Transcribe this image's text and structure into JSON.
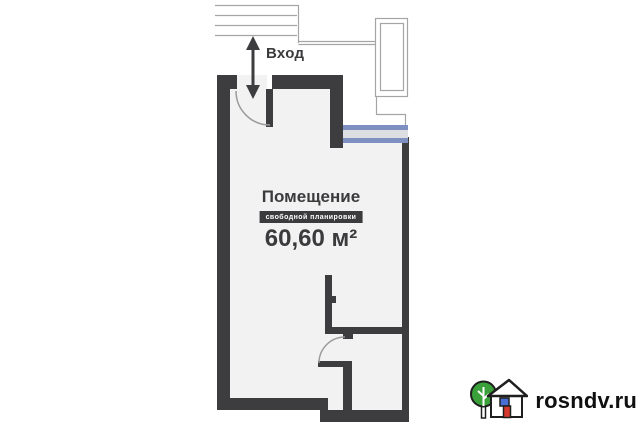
{
  "plan": {
    "entrance": {
      "label": "Вход"
    },
    "room": {
      "title": "Помещение",
      "badge": "свободной планировки",
      "area": "60,60 м²"
    }
  },
  "watermark": {
    "site": "rosndv.ru",
    "logo": "house-and-tree-icon"
  },
  "colors": {
    "wall": "#3d3d3f",
    "room_fill": "#f2f2f3",
    "outline_gray": "#a5a5a7",
    "door_arc_gray": "#9b9b9d",
    "window_blue": "#7e90c2",
    "window_fill": "#dcdee2",
    "badge_bg": "#3b3b3d",
    "badge_text": "#ffffff",
    "logo_tree_green": "#3aa03a",
    "logo_door_red": "#d6392c",
    "logo_window_blue": "#4a6fd4",
    "watermark_text": "#101010"
  }
}
